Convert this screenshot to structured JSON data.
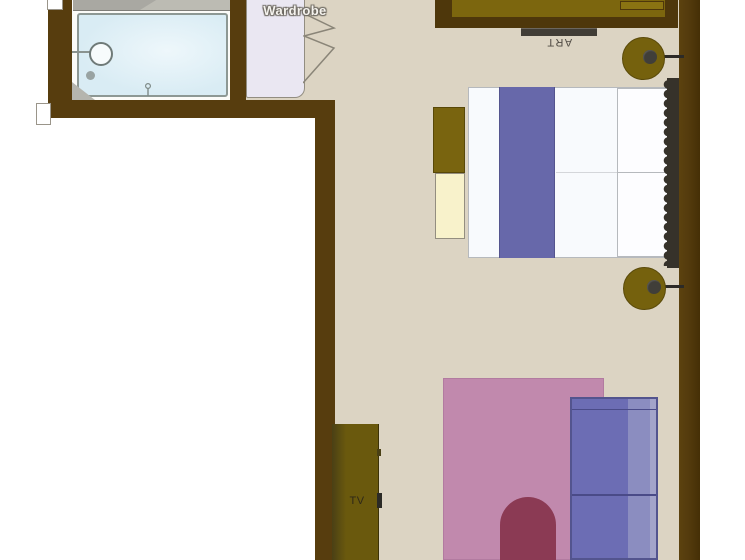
{
  "title": "Hotel room floor plan (top view)",
  "labels": {
    "wardrobe": "Wardrobe",
    "art": "ART",
    "tv": "TV"
  },
  "rooms": [
    {
      "name": "bathroom",
      "items": [
        "vanity-counter",
        "bathtub",
        "round-sink",
        "drain",
        "faucet",
        "corner-shelf"
      ]
    },
    {
      "name": "bedroom",
      "items": [
        "wardrobe",
        "console-table",
        "wall-art",
        "wall-lamp-top",
        "wall-lamp-bottom",
        "double-bed",
        "bed-runner",
        "pillows",
        "tufted-headboard",
        "bench",
        "ottoman",
        "rug",
        "sofa",
        "arch-chair",
        "tv-cabinet"
      ]
    }
  ],
  "palette": {
    "outside": "#ffffff",
    "floor": "#dcd4c3",
    "wall": "#573d0e",
    "bathroom_floor": "#fbfbf8",
    "bathtub": "#d9ecf4",
    "wardrobe_fill": "#eae7f2",
    "console": "#7c660e",
    "art_bar": "#413d36",
    "lamp": "#75610d",
    "mattress": "#f8fafd",
    "bed_runner": "#6768aa",
    "pillow": "#fdfdff",
    "headboard": "#36322a",
    "bench": "#79640f",
    "ottoman": "#f8f2cb",
    "rug": "#c189ad",
    "sofa": "#6c6db4",
    "chair": "#8b3a54",
    "tv_cabinet": "#6a590d"
  }
}
